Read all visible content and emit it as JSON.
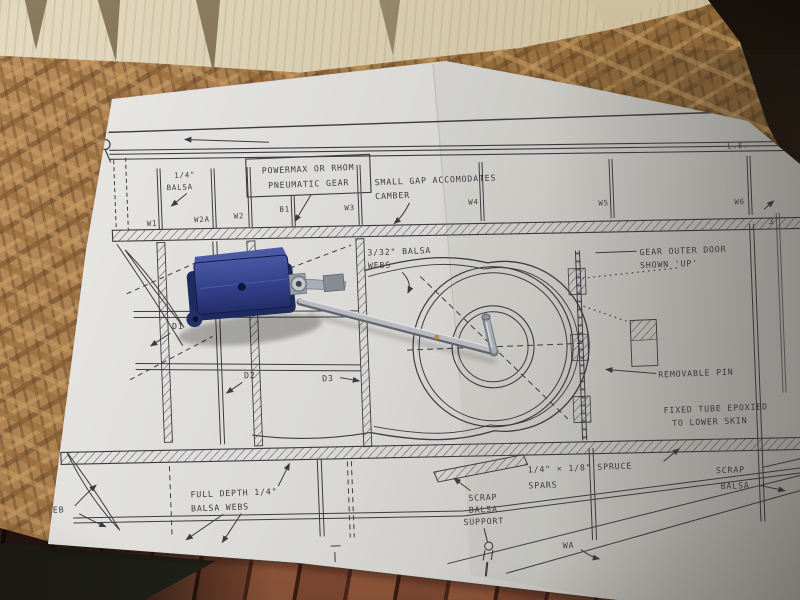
{
  "scene": {
    "colors": {
      "paper": "#e3e2de",
      "ink": "#3c3b41",
      "osb_board": "#b08352",
      "balsa_sheet": "#d9cfb4",
      "floor_wood": "#5f3526",
      "retract_unit_blue": "#3a4a95",
      "strut_metal": "#b7bac1"
    }
  },
  "plan": {
    "edge_label": "L.E.",
    "sheet_marker": "3",
    "rib_labels": {
      "w1": "W1",
      "w2a": "W2A",
      "w2": "W2",
      "b1": "B1",
      "w3": "W3",
      "w4": "W4",
      "w5": "W5",
      "w6": "W6"
    },
    "detail_labels": {
      "d1": "D1",
      "d2": "D2",
      "d3": "D3",
      "wa": "WA",
      "web": "WEB"
    },
    "notes": {
      "quarter_balsa": {
        "l1": "1/4\"",
        "l2": "BALSA"
      },
      "powermax": {
        "l1": "POWERMAX OR RHOM",
        "l2": "PNEUMATIC GEAR"
      },
      "small_gap": {
        "l1": "SMALL GAP ACCOMODATES",
        "l2": "CAMBER"
      },
      "balsa_webs_332": {
        "l1": "3/32\" BALSA",
        "l2": "WEBS"
      },
      "gear_outer_door": {
        "l1": "GEAR OUTER DOOR",
        "l2": "SHOWN 'UP'"
      },
      "removable_pin": "REMOVABLE PIN",
      "fixed_tube": {
        "l1": "FIXED TUBE EPOXIED",
        "l2": "TO LOWER SKIN"
      },
      "full_depth_webs": {
        "l1": "FULL DEPTH 1/4\"",
        "l2": "BALSA WEBS"
      },
      "scrap_balsa_support": {
        "l1": "SCRAP",
        "l2": "BALSA",
        "l3": "SUPPORT"
      },
      "spruce_spars": {
        "l1": "1/4\" × 1/8\" SPRUCE",
        "l2": "SPARS"
      },
      "scrap_balsa": {
        "l1": "SCRAP",
        "l2": "BALSA"
      }
    }
  }
}
